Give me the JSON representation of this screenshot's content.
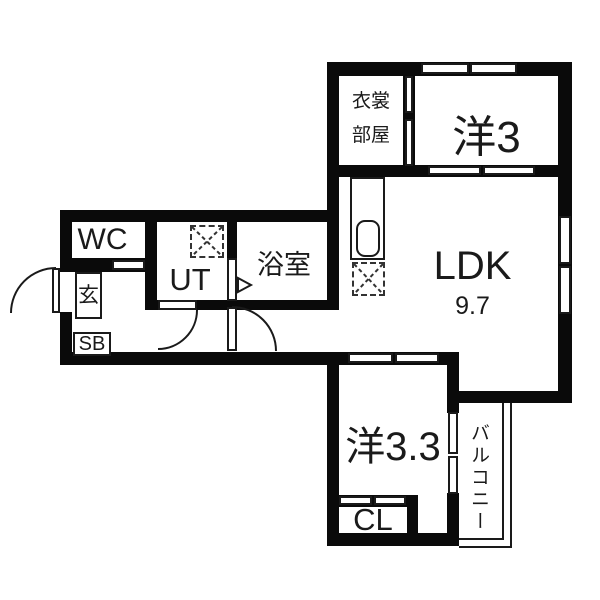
{
  "title": "apartment-floor-plan",
  "colors": {
    "wall": "#0a0a0a",
    "line": "#1a1a1a",
    "text": "#1a1a1a",
    "background": "#ffffff"
  },
  "rooms": {
    "wc": {
      "label": "WC"
    },
    "entrance": {
      "label": "玄"
    },
    "shoe_cabinet": {
      "label": "SB"
    },
    "utility": {
      "label": "UT"
    },
    "bathroom": {
      "label": "浴室"
    },
    "dressing_room": {
      "line1": "衣裳",
      "line2": "部屋"
    },
    "bedroom_north": {
      "label": "洋3"
    },
    "ldk": {
      "label": "LDK",
      "area": "9.7"
    },
    "bedroom_south": {
      "label": "洋3.3"
    },
    "closet": {
      "label": "CL"
    },
    "balcony": {
      "label": "バルコニー"
    }
  }
}
